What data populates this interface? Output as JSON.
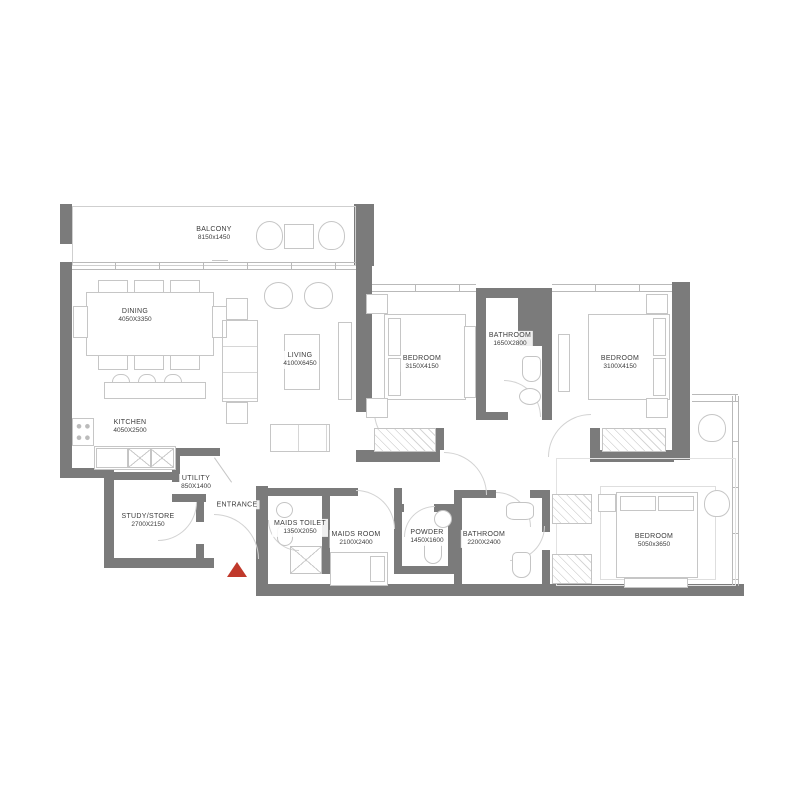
{
  "plan": {
    "type": "apartment-floor-plan",
    "entrance_label": "ENTRANCE"
  },
  "colors": {
    "wall": "#7b7b7b",
    "line": "#c9c9c9",
    "text": "#3c3c3c",
    "entrance_marker": "#c0392b"
  },
  "rooms": {
    "balcony": {
      "name": "BALCONY",
      "dims": "8150x1450"
    },
    "dining": {
      "name": "DINING",
      "dims": "4050X3350"
    },
    "living": {
      "name": "LIVING",
      "dims": "4100X6450"
    },
    "kitchen": {
      "name": "KITCHEN",
      "dims": "4050X2500"
    },
    "bedroom1": {
      "name": "BEDROOM",
      "dims": "3150X4150"
    },
    "bathroom1": {
      "name": "BATHROOM",
      "dims": "1650X2800"
    },
    "bedroom2": {
      "name": "BEDROOM",
      "dims": "3100X4150"
    },
    "utility": {
      "name": "UTILITY",
      "dims": "850X1400"
    },
    "study_store": {
      "name": "STUDY/STORE",
      "dims": "2700X2150"
    },
    "entrance": {
      "name": "ENTRANCE",
      "dims": ""
    },
    "maids_toilet": {
      "name": "MAIDS TOILET",
      "dims": "1350X2050"
    },
    "maids_room": {
      "name": "MAIDS ROOM",
      "dims": "2100X2400"
    },
    "powder": {
      "name": "POWDER",
      "dims": "1450X1600"
    },
    "bathroom2": {
      "name": "BATHROOM",
      "dims": "2200X2400"
    },
    "bedroom3": {
      "name": "BEDROOM",
      "dims": "5050x3650"
    }
  }
}
